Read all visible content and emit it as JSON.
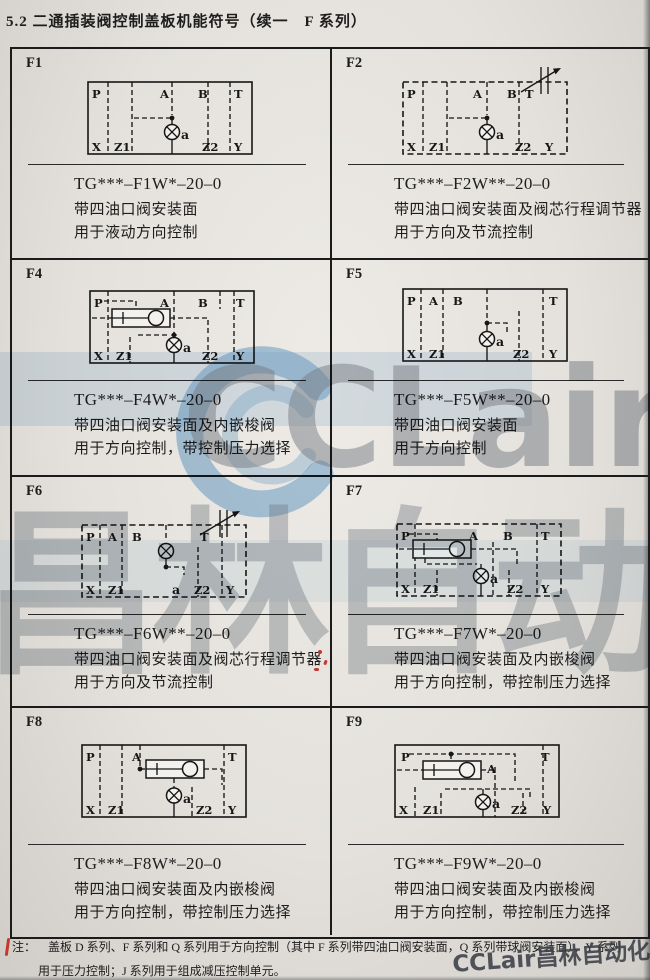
{
  "page": {
    "title": "5.2 二通插装阀控制盖板机能符号（续一　F 系列）",
    "note_label": "注：",
    "note_line1": "盖板 D 系列、F 系列和 Q 系列用于方向控制（其中 F 系列带四油口阀安装面，Q 系列带球阀安装面）、Y 系列",
    "note_line2": "用于压力控制；J 系列用于组成减压控制单元。"
  },
  "watermark": {
    "big_latin": "CCLair",
    "big_cn": "昌林自动化",
    "corner": "CCLair昌林自动化",
    "accent_blue": "#6fa8d8",
    "gray": "#8a929e"
  },
  "cells": [
    {
      "id": "F1",
      "model": "TG***–F1W*–20–0",
      "desc1": "带四油口阀安装面",
      "desc2": "用于液动方向控制",
      "ports_top": [
        "P",
        "A",
        "B",
        "T"
      ],
      "ports_bottom": [
        "X",
        "Z1",
        "a",
        "Z2",
        "Y"
      ]
    },
    {
      "id": "F2",
      "model": "TG***–F2W**–20–0",
      "desc1": "带四油口阀安装面及阀芯行程调节器",
      "desc2": "用于方向及节流控制",
      "ports_top": [
        "P",
        "A",
        "B",
        "T"
      ],
      "ports_bottom": [
        "X",
        "Z1",
        "a",
        "Z2",
        "Y"
      ]
    },
    {
      "id": "F4",
      "model": "TG***–F4W*–20–0",
      "desc1": "带四油口阀安装面及内嵌梭阀",
      "desc2": "用于方向控制，带控制压力选择",
      "ports_top": [
        "P",
        "A",
        "B",
        "T"
      ],
      "ports_bottom": [
        "X",
        "Z1",
        "a",
        "Z2",
        "Y"
      ]
    },
    {
      "id": "F5",
      "model": "TG***–F5W**–20–0",
      "desc1": "带四油口阀安装面",
      "desc2": "用于方向控制",
      "ports_top": [
        "P",
        "A",
        "B",
        "T"
      ],
      "ports_bottom": [
        "X",
        "Z1",
        "a",
        "Z2",
        "Y"
      ]
    },
    {
      "id": "F6",
      "model": "TG***–F6W**–20–0",
      "desc1": "带四油口阀安装面及阀芯行程调节器",
      "desc2": "用于方向及节流控制",
      "ports_top": [
        "P",
        "A",
        "B",
        "T"
      ],
      "ports_bottom": [
        "X",
        "Z1",
        "a",
        "Z2",
        "Y"
      ]
    },
    {
      "id": "F7",
      "model": "TG***–F7W*–20–0",
      "desc1": "带四油口阀安装面及内嵌梭阀",
      "desc2": "用于方向控制，带控制压力选择",
      "ports_top": [
        "P",
        "A",
        "B",
        "T"
      ],
      "ports_bottom": [
        "X",
        "Z1",
        "a",
        "Z2",
        "Y"
      ]
    },
    {
      "id": "F8",
      "model": "TG***–F8W*–20–0",
      "desc1": "带四油口阀安装面及内嵌梭阀",
      "desc2": "用于方向控制，带控制压力选择",
      "ports_top": [
        "P",
        "A",
        "T"
      ],
      "ports_bottom": [
        "X",
        "Z1",
        "a",
        "Z2",
        "Y"
      ]
    },
    {
      "id": "F9",
      "model": "TG***–F9W*–20–0",
      "desc1": "带四油口阀安装面及内嵌梭阀",
      "desc2": "用于方向控制，带控制压力选择",
      "ports_top": [
        "P",
        "A",
        "T"
      ],
      "ports_bottom": [
        "X",
        "Z1",
        "a",
        "Z2",
        "Y"
      ]
    }
  ]
}
